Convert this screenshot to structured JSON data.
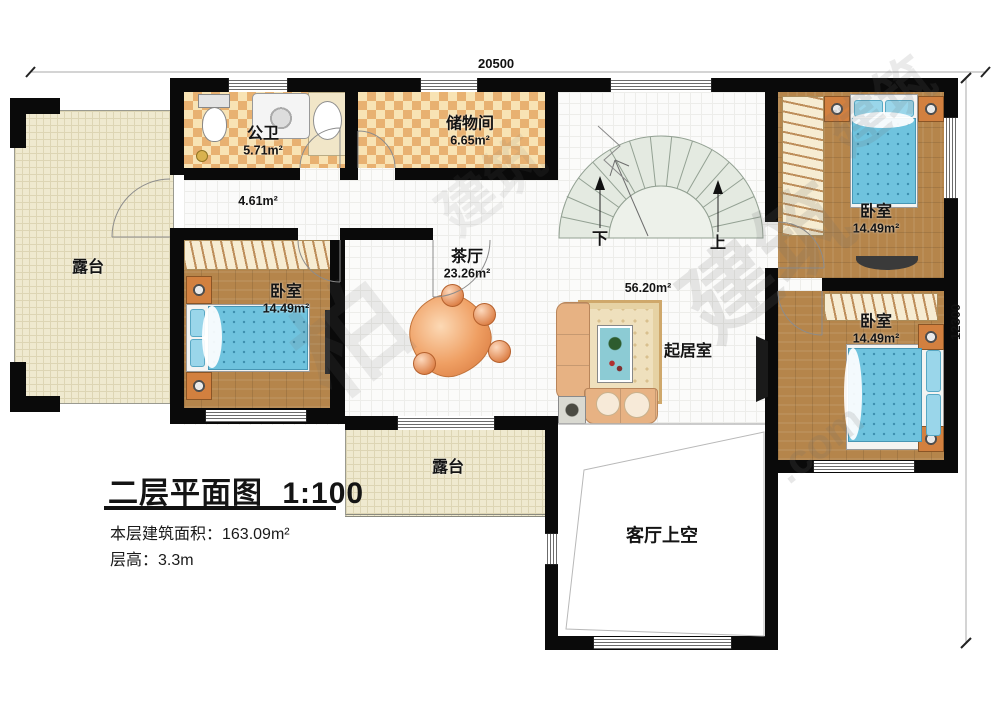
{
  "title_block": {
    "title": "二层平面图",
    "scale": "1:100",
    "area_line": "本层建筑面积：163.09m²",
    "height_line": "层高：3.3m"
  },
  "dimensions": {
    "width": "20500",
    "height": "12300"
  },
  "rooms": {
    "bathroom": {
      "name": "公卫",
      "area": "5.71m²"
    },
    "storage": {
      "name": "储物间",
      "area": "6.65m²"
    },
    "hall": {
      "area": "4.61m²"
    },
    "tea_room": {
      "name": "茶厅",
      "area": "23.26m²"
    },
    "landing": {
      "area": "56.20m²"
    },
    "living": {
      "name": "起居室"
    },
    "bedroom_left": {
      "name": "卧室",
      "area": "14.49m²"
    },
    "bedroom_top_right": {
      "name": "卧室",
      "area": "14.49m²"
    },
    "bedroom_bottom_right": {
      "name": "卧室",
      "area": "14.49m²"
    },
    "terrace_left": {
      "name": "露台"
    },
    "terrace_middle": {
      "name": "露台"
    },
    "living_void": {
      "name": "客厅上空"
    }
  },
  "stairs": {
    "down_label": "下",
    "up_label": "上"
  },
  "watermark": {
    "char": "柏",
    "word": "建筑",
    "domain": ".com"
  },
  "colors": {
    "wall": "#0a0a0a",
    "checker_dark": "#e8b171",
    "checker_light": "#f8e3b4",
    "wood": "#b5854b",
    "bed_blue": "#6fc3de",
    "terrace": "#efe9cf",
    "stair_fill": "#e4eae1",
    "sofa_tan": "#e7b283"
  }
}
